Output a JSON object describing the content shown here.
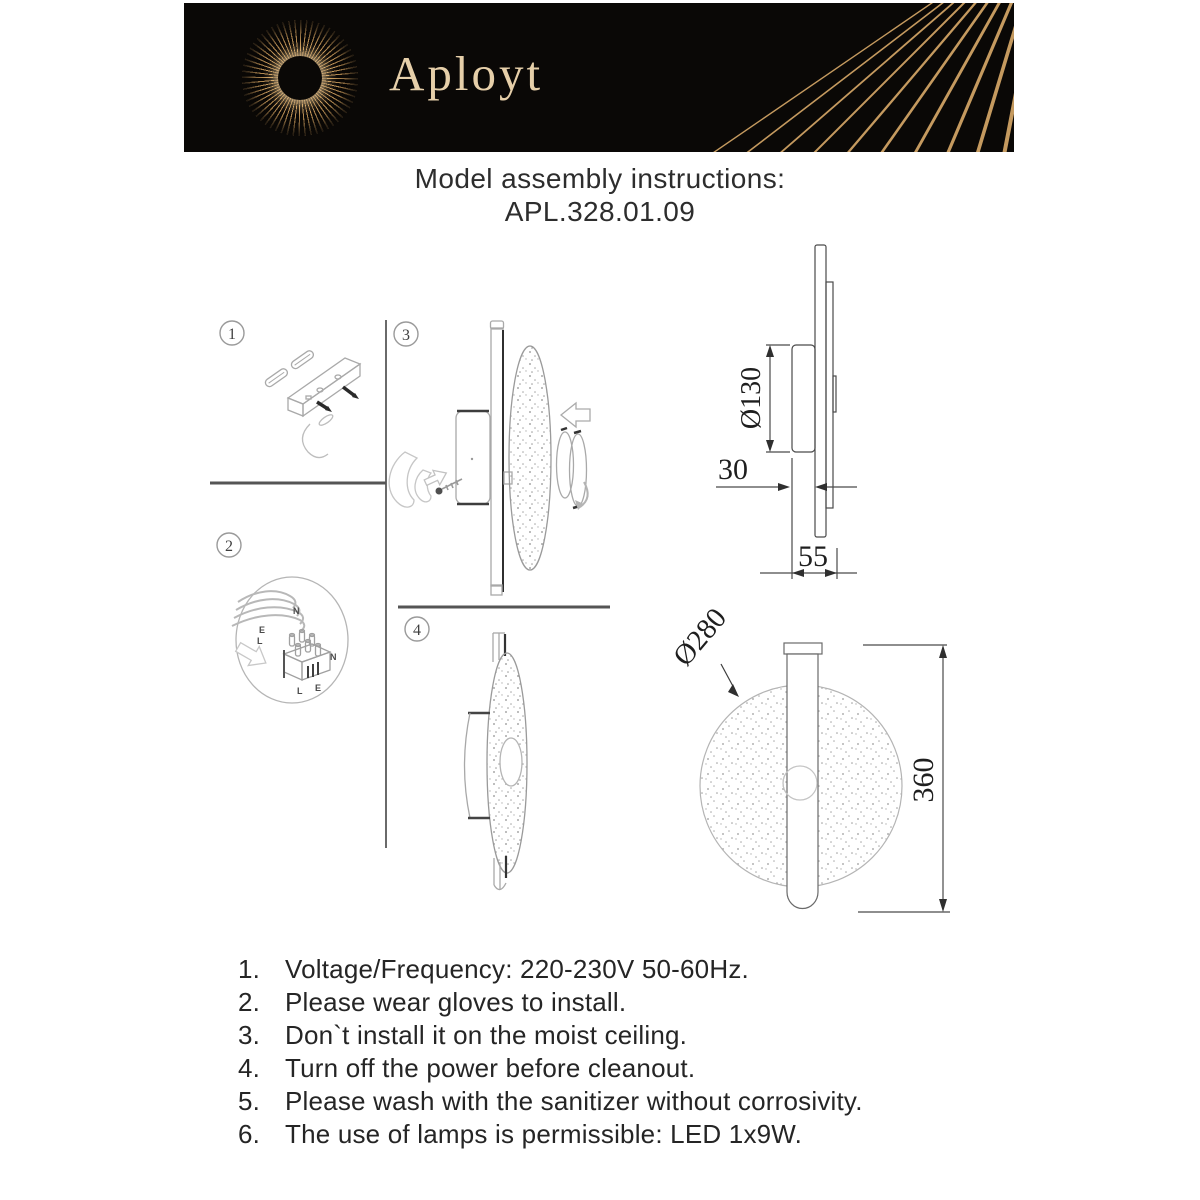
{
  "header": {
    "brand": "Aployt"
  },
  "title": {
    "heading": "Model assembly instructions:",
    "model": "APL.328.01.09"
  },
  "steps": {
    "s1": "1",
    "s2": "2",
    "s3": "3",
    "s4": "4"
  },
  "wiring": {
    "wire_n": "N",
    "wire_e": "E",
    "wire_l": "L",
    "term_n": "N",
    "term_l": "L",
    "term_e": "E"
  },
  "dimensions": {
    "mount_diameter": "Ø130",
    "depth_box": "30",
    "depth_total": "55",
    "shade_diameter": "Ø280",
    "height": "360"
  },
  "instructions": {
    "items": [
      {
        "num": "1.",
        "text": "Voltage/Frequency: 220-230V 50-60Hz."
      },
      {
        "num": "2.",
        "text": "Please wear gloves to install."
      },
      {
        "num": "3.",
        "text": "Don`t install it on the moist ceiling."
      },
      {
        "num": "4.",
        "text": "Turn off the power before cleanout."
      },
      {
        "num": "5.",
        "text": "Please wash with the sanitizer without corrosivity."
      },
      {
        "num": "6.",
        "text": "The use of lamps is permissible: LED 1x9W."
      }
    ]
  },
  "colors": {
    "header_bg": "#0a0806",
    "gold": "#c59a5f",
    "brand_text": "#e6cfa9",
    "sketch_gray": "#a9a9a9",
    "dim_line": "#3c3c3c",
    "body_text": "#252525"
  }
}
